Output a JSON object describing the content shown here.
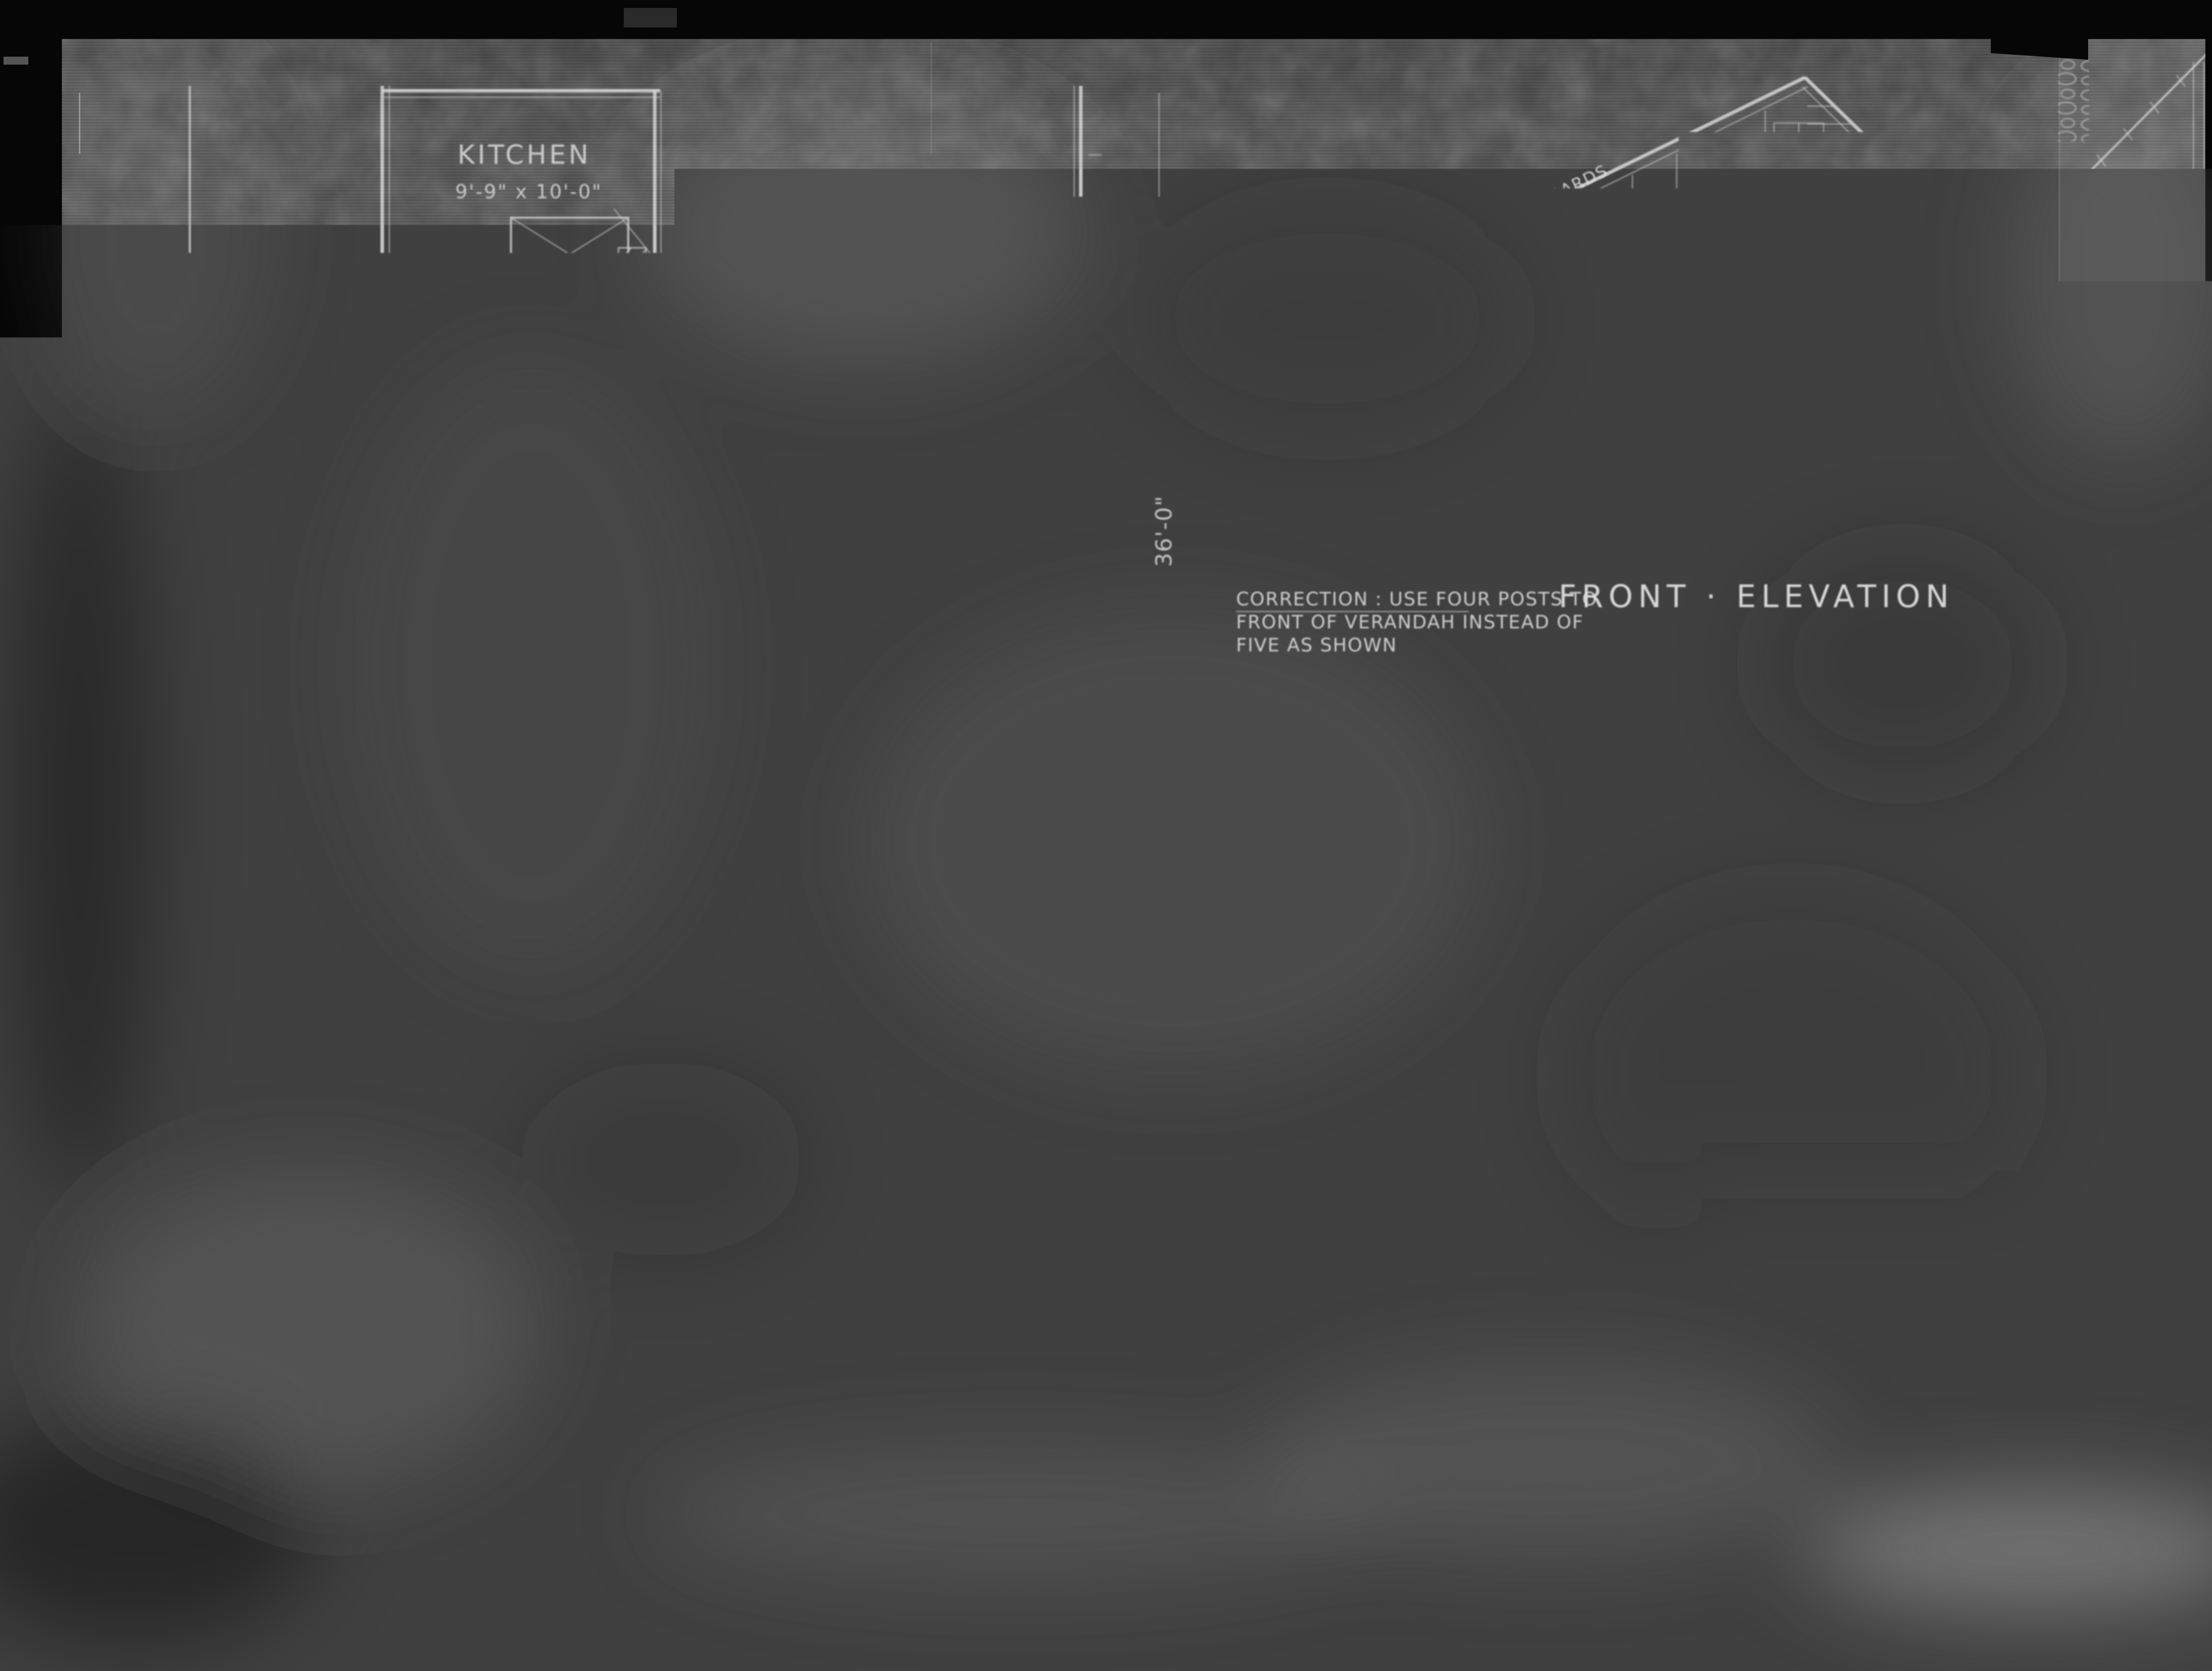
{
  "document": {
    "kind": "architectural blueprint photostat",
    "colors": {
      "photo_black": "#050505",
      "paper_dark": "#404040",
      "paper_light_strip": "#4b4b4b",
      "linework": "#e8e8e8",
      "stamp_paper": "#e6e4de",
      "stamp_ink": "#222222"
    }
  },
  "floor_plan": {
    "title": "PLAN",
    "rooms": {
      "kitchen": {
        "name": "KITCHEN",
        "size": "9'-9\" x 10'-0\""
      },
      "bed1": {
        "name": "BED ROOM",
        "size": "9'-9\" x 10'-0\""
      },
      "living": {
        "name": "LIVING ROOM",
        "size": "15'-9\" x 34'-0\""
      },
      "bed2": {
        "name": "BED ROOM",
        "size": "9'-9\" x 10'-0\""
      }
    },
    "closet1": "CLOS.",
    "closet2": "CLOS.",
    "closet3": "CLOS.",
    "verandah_left": "VERANDAH",
    "verandah_bottom": "VERANDAH",
    "centerline_note": "℄ of RM.",
    "posts_note": "7\"x 7\" POSTS",
    "dims": {
      "verandah_width": "7'-0\"",
      "offset": "4'-6\"",
      "house_width": "27'-0\"",
      "stair_bay": "6'-0\"",
      "living_depth": "16'-0\"",
      "verandah_depth": "8'-0\"",
      "total_depth": "36'-0\""
    }
  },
  "front_elevation": {
    "title": "FRONT · ELEVATION",
    "pitch_note": "⅓ PITCH",
    "verge_note": "1¼\"x 8\" VERGE BOARDS",
    "stucco_note": "STUCCO",
    "pier_note_line1": "STONE",
    "pier_note_line2": "PIERS",
    "height_dim": "7'6\"",
    "correction_line1": "CORRECTION : USE FOUR POSTS TO",
    "correction_line2": "FRONT OF VERANDAH INSTEAD OF",
    "correction_line3": "FIVE AS SHOWN"
  },
  "side_elevation": {
    "title": "RIGHT · SIDE · ELEVATION",
    "stucco_note": "STUCCO"
  },
  "corner_detail": {
    "material_note": "STONE"
  },
  "stamps": {
    "page_stamp": "3 of/de",
    "repeat_line1": "Repeat",
    "repeat_line2": "Répétition"
  }
}
